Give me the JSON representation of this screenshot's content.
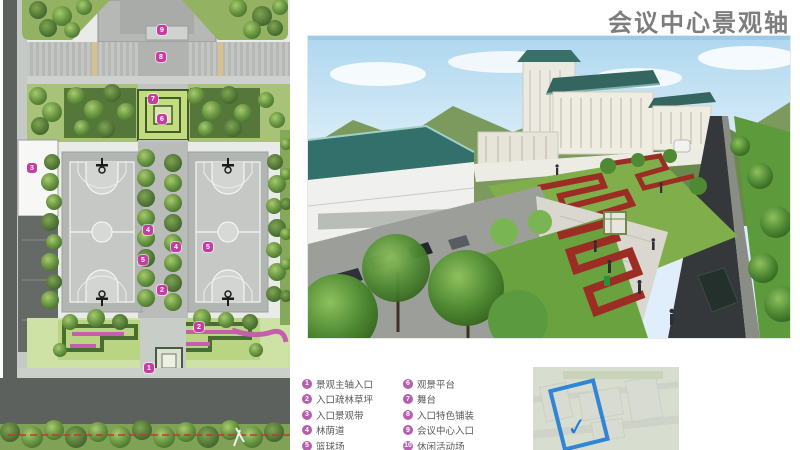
{
  "title": "会议中心景观轴",
  "legend": {
    "items": [
      {
        "num": "1",
        "label": "景观主轴入口"
      },
      {
        "num": "2",
        "label": "入口疏林草坪"
      },
      {
        "num": "3",
        "label": "入口景观带"
      },
      {
        "num": "4",
        "label": "林荫道"
      },
      {
        "num": "5",
        "label": "篮球场"
      },
      {
        "num": "6",
        "label": "观景平台"
      },
      {
        "num": "7",
        "label": "舞台"
      },
      {
        "num": "8",
        "label": "入口特色铺装"
      },
      {
        "num": "9",
        "label": "会议中心入口"
      },
      {
        "num": "10",
        "label": "休闲活动场"
      }
    ]
  },
  "plan": {
    "markers": [
      {
        "n": "9",
        "x": 162,
        "y": 30
      },
      {
        "n": "8",
        "x": 161,
        "y": 57
      },
      {
        "n": "7",
        "x": 153,
        "y": 99
      },
      {
        "n": "6",
        "x": 162,
        "y": 119
      },
      {
        "n": "3",
        "x": 32,
        "y": 168
      },
      {
        "n": "4",
        "x": 148,
        "y": 230
      },
      {
        "n": "4",
        "x": 176,
        "y": 247
      },
      {
        "n": "5",
        "x": 143,
        "y": 260
      },
      {
        "n": "5",
        "x": 208,
        "y": 247
      },
      {
        "n": "2",
        "x": 162,
        "y": 290
      },
      {
        "n": "2",
        "x": 199,
        "y": 327
      },
      {
        "n": "1",
        "x": 149,
        "y": 368
      }
    ]
  },
  "minimap": {
    "check": "✓"
  },
  "colors": {
    "marker_magenta": "#c93aa4",
    "legend_badge": "#b55fae",
    "title_gray": "#7d7d7d",
    "map_blue": "#1e7bd7",
    "hedge_red": "#9c2d24",
    "roof_teal": "#35655f"
  }
}
